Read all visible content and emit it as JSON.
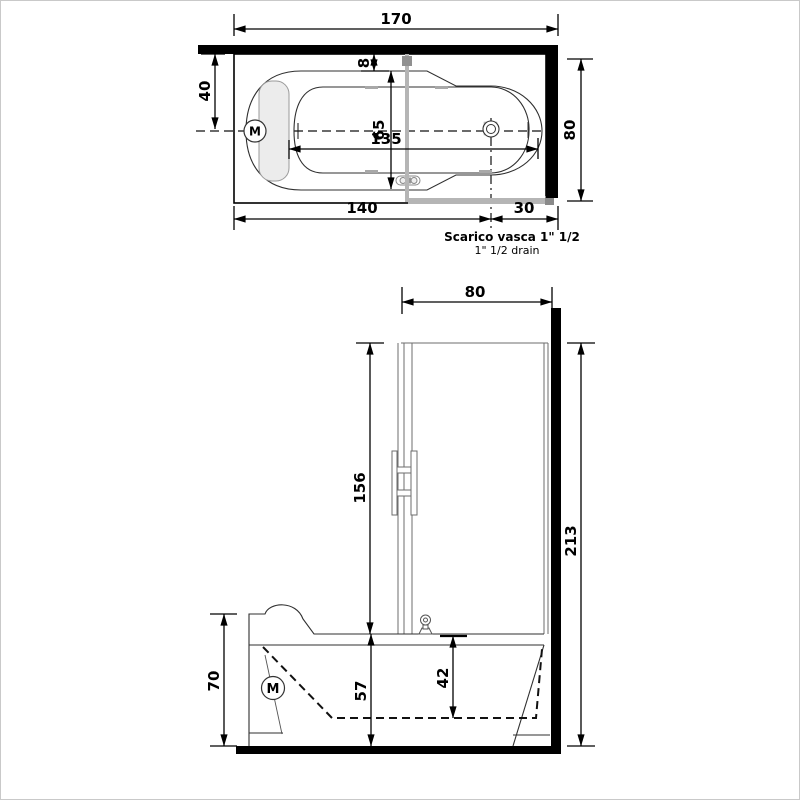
{
  "drawing": {
    "type": "bathtub-with-shower-technical-drawing",
    "colors": {
      "line": "#000000",
      "tub_line": "#2f2f2f",
      "glass_gray": "#b5b5b5",
      "glass_dark_gray": "#8a8a8a",
      "headrest_fill": "#ececec",
      "background": "#ffffff"
    }
  },
  "top_view": {
    "dims": {
      "d170": "170",
      "d40": "40",
      "d8": "8",
      "d65": "65",
      "d135": "135",
      "d80": "80",
      "d140": "140",
      "d30": "30"
    },
    "motor_label": "M",
    "drain_note_line1": "Scarico vasca 1\" 1/2",
    "drain_note_line2": "1\" 1/2  drain"
  },
  "front_view": {
    "dims": {
      "d80": "80",
      "d156": "156",
      "d213": "213",
      "d70": "70",
      "d57": "57",
      "d42": "42"
    },
    "motor_label": "M"
  }
}
